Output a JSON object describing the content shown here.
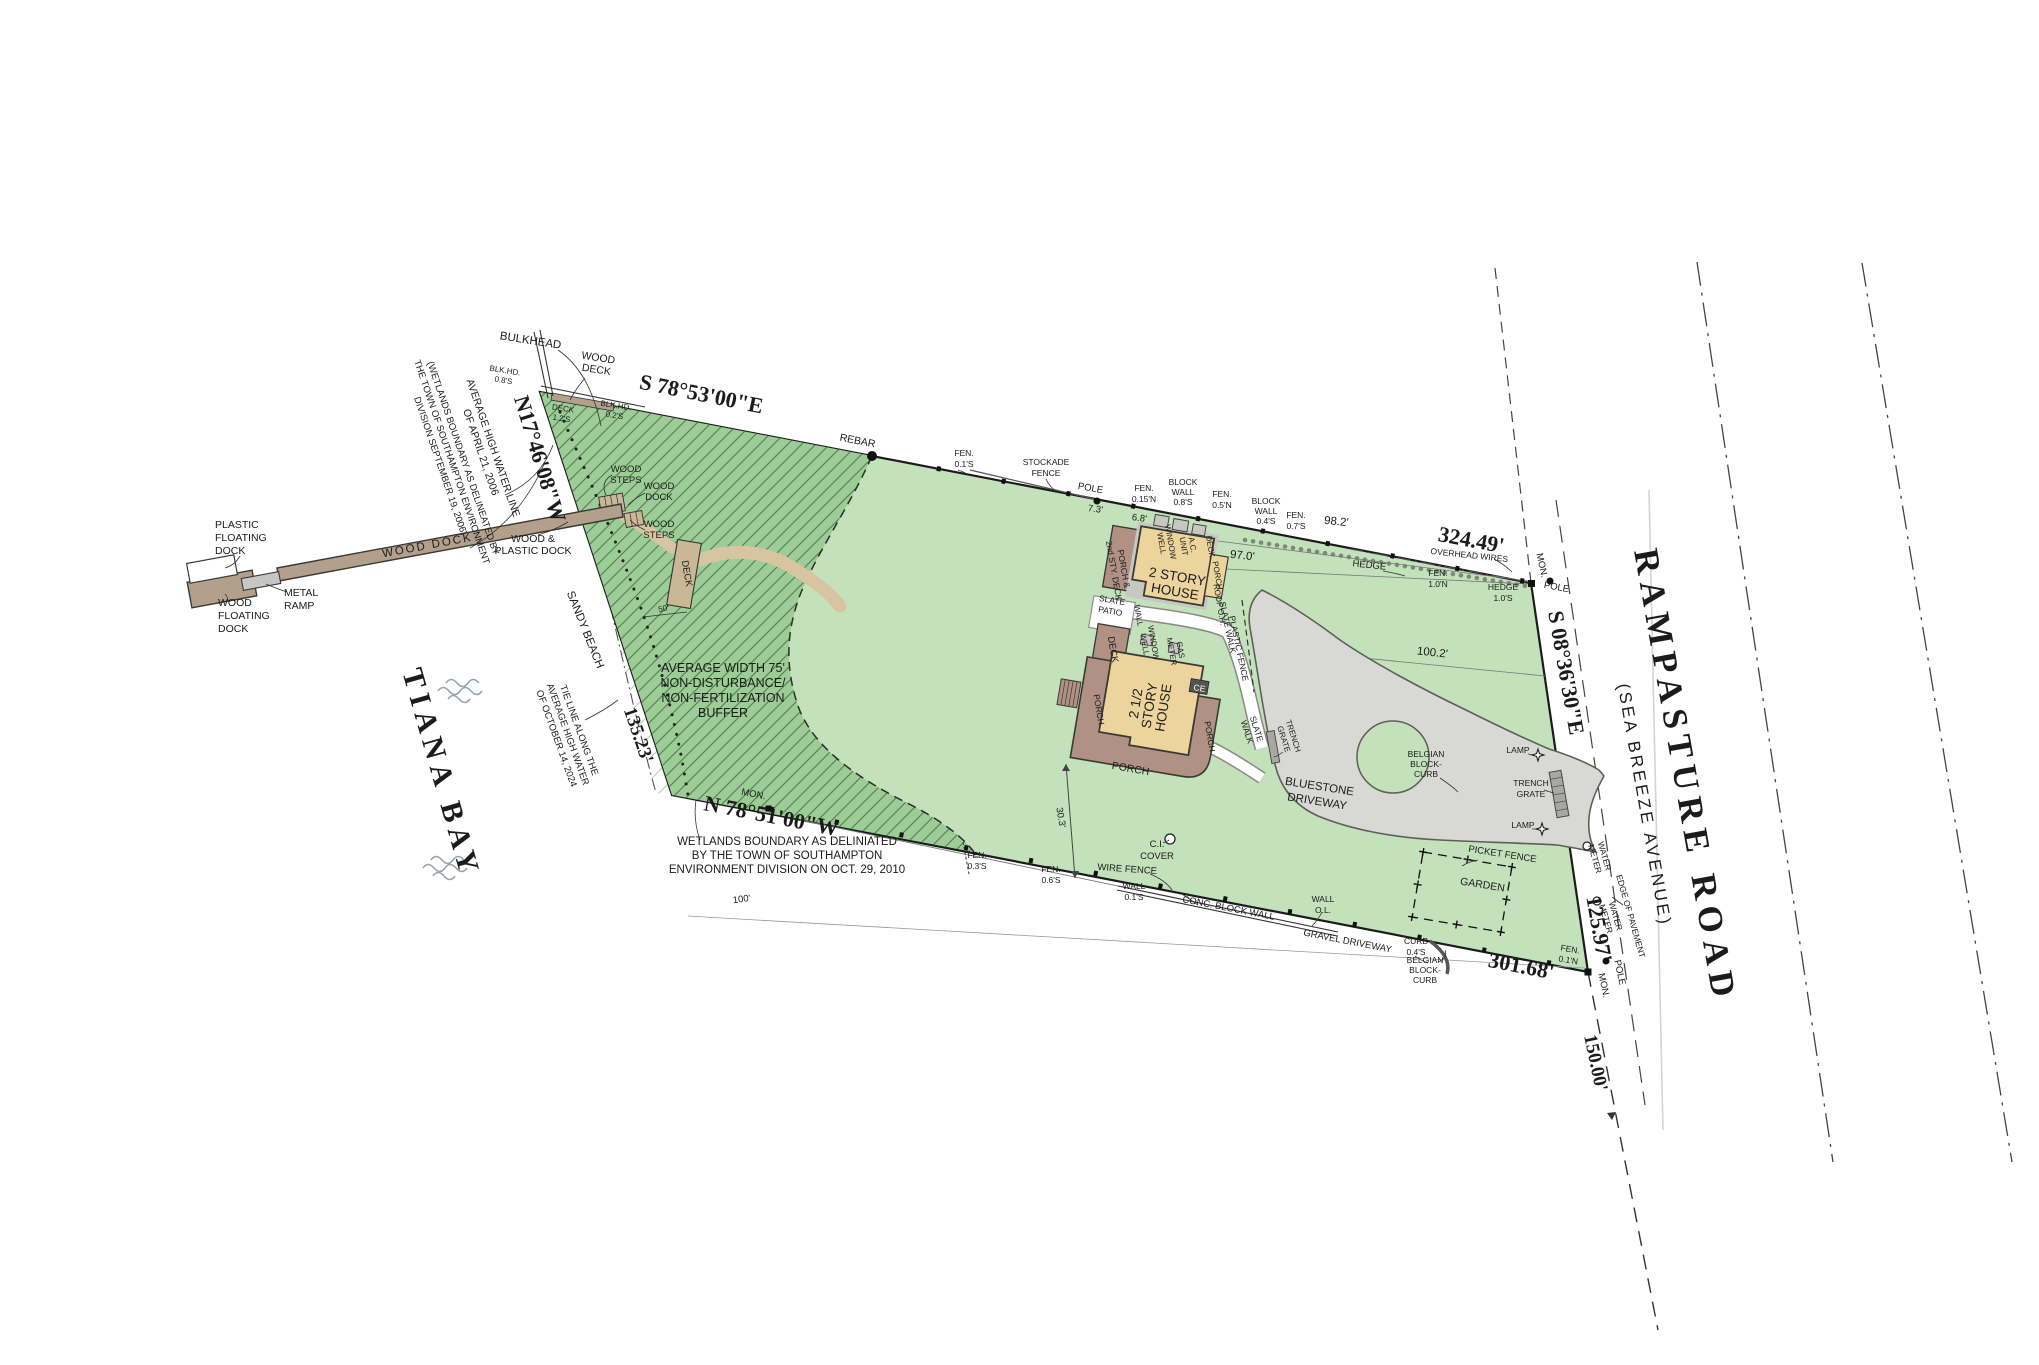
{
  "map": {
    "waterbody": "TIANA BAY",
    "road_name": "RAMPASTURE ROAD",
    "road_alt": "(SEA BREEZE AVENUE)"
  },
  "colors": {
    "lawn": "#c3e1ba",
    "buffer_green": "#9ccd96",
    "hatch_line": "#567a50",
    "house_tan": "#ecd49c",
    "porch_brown": "#b19184",
    "dock_brown": "#b3a08c",
    "driveway_gray": "#d8d8d4",
    "sand_path": "#d7c5a2",
    "ink": "#1b1b1b"
  },
  "boundary": {
    "bearing_north": "S 78°53'00\"E",
    "dist_north": "324.49'",
    "bearing_west": "N17°46'08\"W",
    "tie_dist_west": "135.23'",
    "bearing_south": "N 78°51'00\"W",
    "dist_south": "301.68'",
    "bearing_east": "S 08°36'30\"E",
    "dist_east": "125.97'",
    "road_frontage_south": "150.00'",
    "tie_line_100": "100'",
    "monument": "MON.",
    "pole": "POLE",
    "rebar": "REBAR"
  },
  "notes": {
    "ahw_2006": [
      "AVERAGE HIGH WATER LINE",
      "OF APRIL 21, 2006"
    ],
    "wetlands_2006": [
      "(WETLANDS BOUNDARY AS DELINEATED BY",
      "THE TOWN OF SOUTHAMPTON ENVIRONMENT",
      "DIVISION SEPTEMBER 19, 2006)"
    ],
    "tie_line_2024": [
      "TIE LINE ALONG THE",
      "AVERAGE HIGH WATER",
      "OF OCTOBER 14, 2024"
    ],
    "buffer": [
      "AVERAGE WIDTH 75'",
      "NON-DISTURBANCE/",
      "NON-FERTILIZATION",
      "BUFFER"
    ],
    "wetlands_2010": [
      "WETLANDS BOUNDARY AS DELINIATED",
      "BY THE TOWN OF SOUTHAMPTON",
      "ENVIRONMENT DIVISION ON OCT. 29, 2010"
    ]
  },
  "shore": {
    "bulkhead": "BULKHEAD",
    "wood_deck": [
      "WOOD",
      "DECK"
    ],
    "blkhd_1": [
      "BLK.HD.",
      "0.8'S"
    ],
    "blkhd_2": [
      "BLK.HD.",
      "0.2'S"
    ],
    "deck_offset": [
      "DECK",
      "1.2'S"
    ],
    "sandy_beach": "SANDY BEACH",
    "wood_steps": [
      "WOOD",
      "STEPS"
    ],
    "wood_dock_small": [
      "WOOD",
      "DOCK"
    ],
    "deck": "DECK",
    "buffer_50": "50'"
  },
  "dock": {
    "plastic_floating": [
      "PLASTIC",
      "FLOATING",
      "DOCK"
    ],
    "metal_ramp": [
      "METAL",
      "RAMP"
    ],
    "wood_floating": [
      "WOOD",
      "FLOATING",
      "DOCK"
    ],
    "wood_dock": "WOOD DOCK",
    "wood_plastic": [
      "WOOD &",
      "PLASTIC DOCK"
    ]
  },
  "north_line": {
    "fen_01s": [
      "FEN.",
      "0.1'S"
    ],
    "stockade": [
      "STOCKADE",
      "FENCE"
    ],
    "d7_3": "7.3'",
    "d6_8": "6.8'",
    "fen_015n": [
      "FEN.",
      "0.15'N"
    ],
    "block_wall_08": [
      "BLOCK",
      "WALL",
      "0.8'S"
    ],
    "fen_05n": [
      "FEN.",
      "0.5'N"
    ],
    "block_wall_04": [
      "BLOCK",
      "WALL",
      "0.4'S"
    ],
    "fen_07s": [
      "FEN.",
      "0.7'S"
    ],
    "d98_2": "98.2'",
    "overhead_wires": "OVERHEAD WIRES",
    "hedge": "HEDGE",
    "fen_10n": [
      "FEN.",
      "1.0'N"
    ],
    "hedge_10s": [
      "HEDGE",
      "1.0'S"
    ]
  },
  "houses": {
    "house_2story": [
      "2 STORY",
      "HOUSE"
    ],
    "house_2half": [
      "2 1/2",
      "STORY",
      "HOUSE"
    ],
    "porch_2nd": [
      "PORCH &",
      "2nd STY. DECK"
    ],
    "window_well": [
      "WINDOW",
      "WELL"
    ],
    "ac_unit": [
      "A.C.",
      "UNIT"
    ],
    "deck_dot": "DECK.",
    "porch": "PORCH",
    "slate_patio": [
      "SLATE",
      "PATIO"
    ],
    "wall": "WALL",
    "roof_oh": "ROOF O.H.",
    "slate_walk": "SLATE WALK",
    "plastic_fence": "PLASTIC FENCE",
    "deck": "DECK",
    "gas_meter": [
      "GAS",
      "METER"
    ],
    "ce": "CE",
    "slate_walk2": [
      "SLATE",
      "WALK"
    ],
    "trench_grate": [
      "TRENCH",
      "GRATE"
    ],
    "d97_0": "97.0'",
    "d100_2": "100.2'",
    "d30_3": "30.3'",
    "ci_cover": [
      "C.I.",
      "COVER"
    ]
  },
  "yard": {
    "bluestone": [
      "BLUESTONE",
      "DRIVEWAY"
    ],
    "belgian_block": [
      "BELGIAN",
      "BLOCK-",
      "CURB"
    ],
    "lamp": "LAMP",
    "garden": "GARDEN",
    "picket_fence": "PICKET FENCE",
    "gravel_driveway": "GRAVEL DRIVEWAY"
  },
  "south_line": {
    "fen_03s": [
      "FEN.",
      "0.3'S"
    ],
    "fen_06s": [
      "FEN.",
      "0.6'S"
    ],
    "wire_fence": "WIRE FENCE",
    "wall_01s": [
      "WALL",
      "0.1'S"
    ],
    "conc_block_wall": "CONC. BLOCK WALL",
    "wall_ol": [
      "WALL",
      "O.L."
    ],
    "curb_04s": [
      "CURB",
      "0.4'S"
    ],
    "fen_01n": [
      "FEN.",
      "0.1'N"
    ]
  },
  "road_side": {
    "water_meter": [
      "WATER",
      "METER"
    ],
    "edge_of_pavement": "EDGE OF PAVEMENT"
  }
}
